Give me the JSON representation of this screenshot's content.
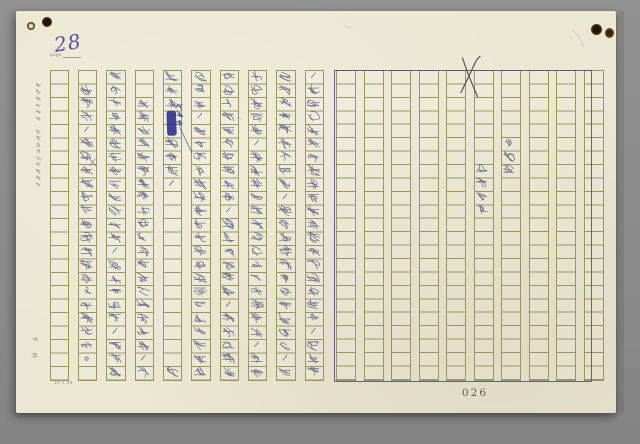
{
  "page_header": {
    "page_label": "page",
    "handwritten_number": "28"
  },
  "footer": {
    "printed_page_number": "026",
    "grid_size_note": "20 × 20"
  },
  "margins": {
    "print_top": "謄寫紙廿字廿",
    "print_bottom": "五行四百字詰原稿紙",
    "brand": "文範"
  },
  "right_page": {
    "crossed_out_mark": "X",
    "labels": [
      "第七間",
      "爬上兩步"
    ]
  },
  "annotations": {
    "insertion_note": "情況下",
    "small_cross": "×"
  },
  "handwriting": {
    "columns_rtl": [
      [
        "ノ",
        "故",
        "人",
        "之",
        "紛",
        "紛",
        "依",
        "然",
        "纇",
        "遭",
        "噴",
        "出",
        "草",
        "這",
        "人",
        "不",
        "在",
        "怒",
        "人",
        "，",
        "為",
        "了",
        "不"
      ],
      [
        "們",
        "不",
        "神",
        "向",
        "東",
        "南",
        "方",
        "覓",
        "脫",
        "，",
        "維",
        "向",
        "波",
        "凉",
        "世",
        "畫",
        "隱",
        "上",
        "測",
        "話",
        "史",
        "，",
        "不"
      ],
      [
        "怎",
        "空",
        "芳",
        "之",
        "嗎",
        "，",
        "而",
        "且",
        "不",
        "停",
        "使",
        "阿",
        "學",
        "人",
        "有",
        "過",
        "敗",
        "的",
        "機",
        "會",
        "，",
        "大",
        "笑"
      ],
      [
        "這",
        "間",
        "因",
        "已",
        "經",
        "鐵",
        "談",
        "人",
        "彼",
        "說",
        "，",
        "住",
        "聞",
        "改",
        "進",
        "以",
        "外",
        "，",
        "主",
        "沒",
        "有",
        "告",
        "冲"
      ],
      [
        "底",
        "如",
        "下",
        "，",
        "因",
        "為",
        "早",
        "秌",
        "科",
        "口",
        "河",
        "人",
        "決",
        "不",
        "全",
        "在",
        "層",
        "地",
        "行",
        "西",
        "到",
        "面",
        "坡"
      ],
      [
        "有",
        "利",
        "以",
        "■",
        "■",
        "丟",
        "性",
        "塢",
        "、",
        "",
        "",
        "",
        "",
        "",
        "",
        "",
        "",
        "",
        "",
        "",
        "",
        "",
        "住"
      ],
      [
        "",
        "",
        "如",
        "方",
        "以",
        "規",
        "上",
        "可",
        "以",
        "將",
        "這",
        "人",
        "冷",
        "了",
        "不",
        "可",
        "附",
        "立",
        "以",
        "步",
        "格",
        "，",
        "往"
      ],
      [
        "還",
        "使",
        "人",
        "們",
        "一",
        "向",
        "全",
        "有",
        "不",
        "同",
        "之",
        "害",
        "古",
        "，",
        "小",
        "大",
        "角",
        "之",
        "位",
        "，",
        "中",
        "以",
        "指"
      ],
      [
        "",
        "循",
        "波",
        "心",
        "，",
        "寬",
        "芳",
        "問",
        "還",
        "全",
        "維",
        "間",
        "時",
        "人",
        "寺",
        "連",
        "以",
        "辯",
        "論",
        "這",
        "日",
        "。",
        ""
      ]
    ]
  },
  "colors": {
    "background": "#8c8c8c",
    "paper": "#ece7d2",
    "grid_line": "#9b9562",
    "frame": "#45507a",
    "ink": "#5b6486",
    "blue_ink": "#3238a0",
    "small_print": "#8d8766",
    "page_number": "#4b4b55"
  }
}
